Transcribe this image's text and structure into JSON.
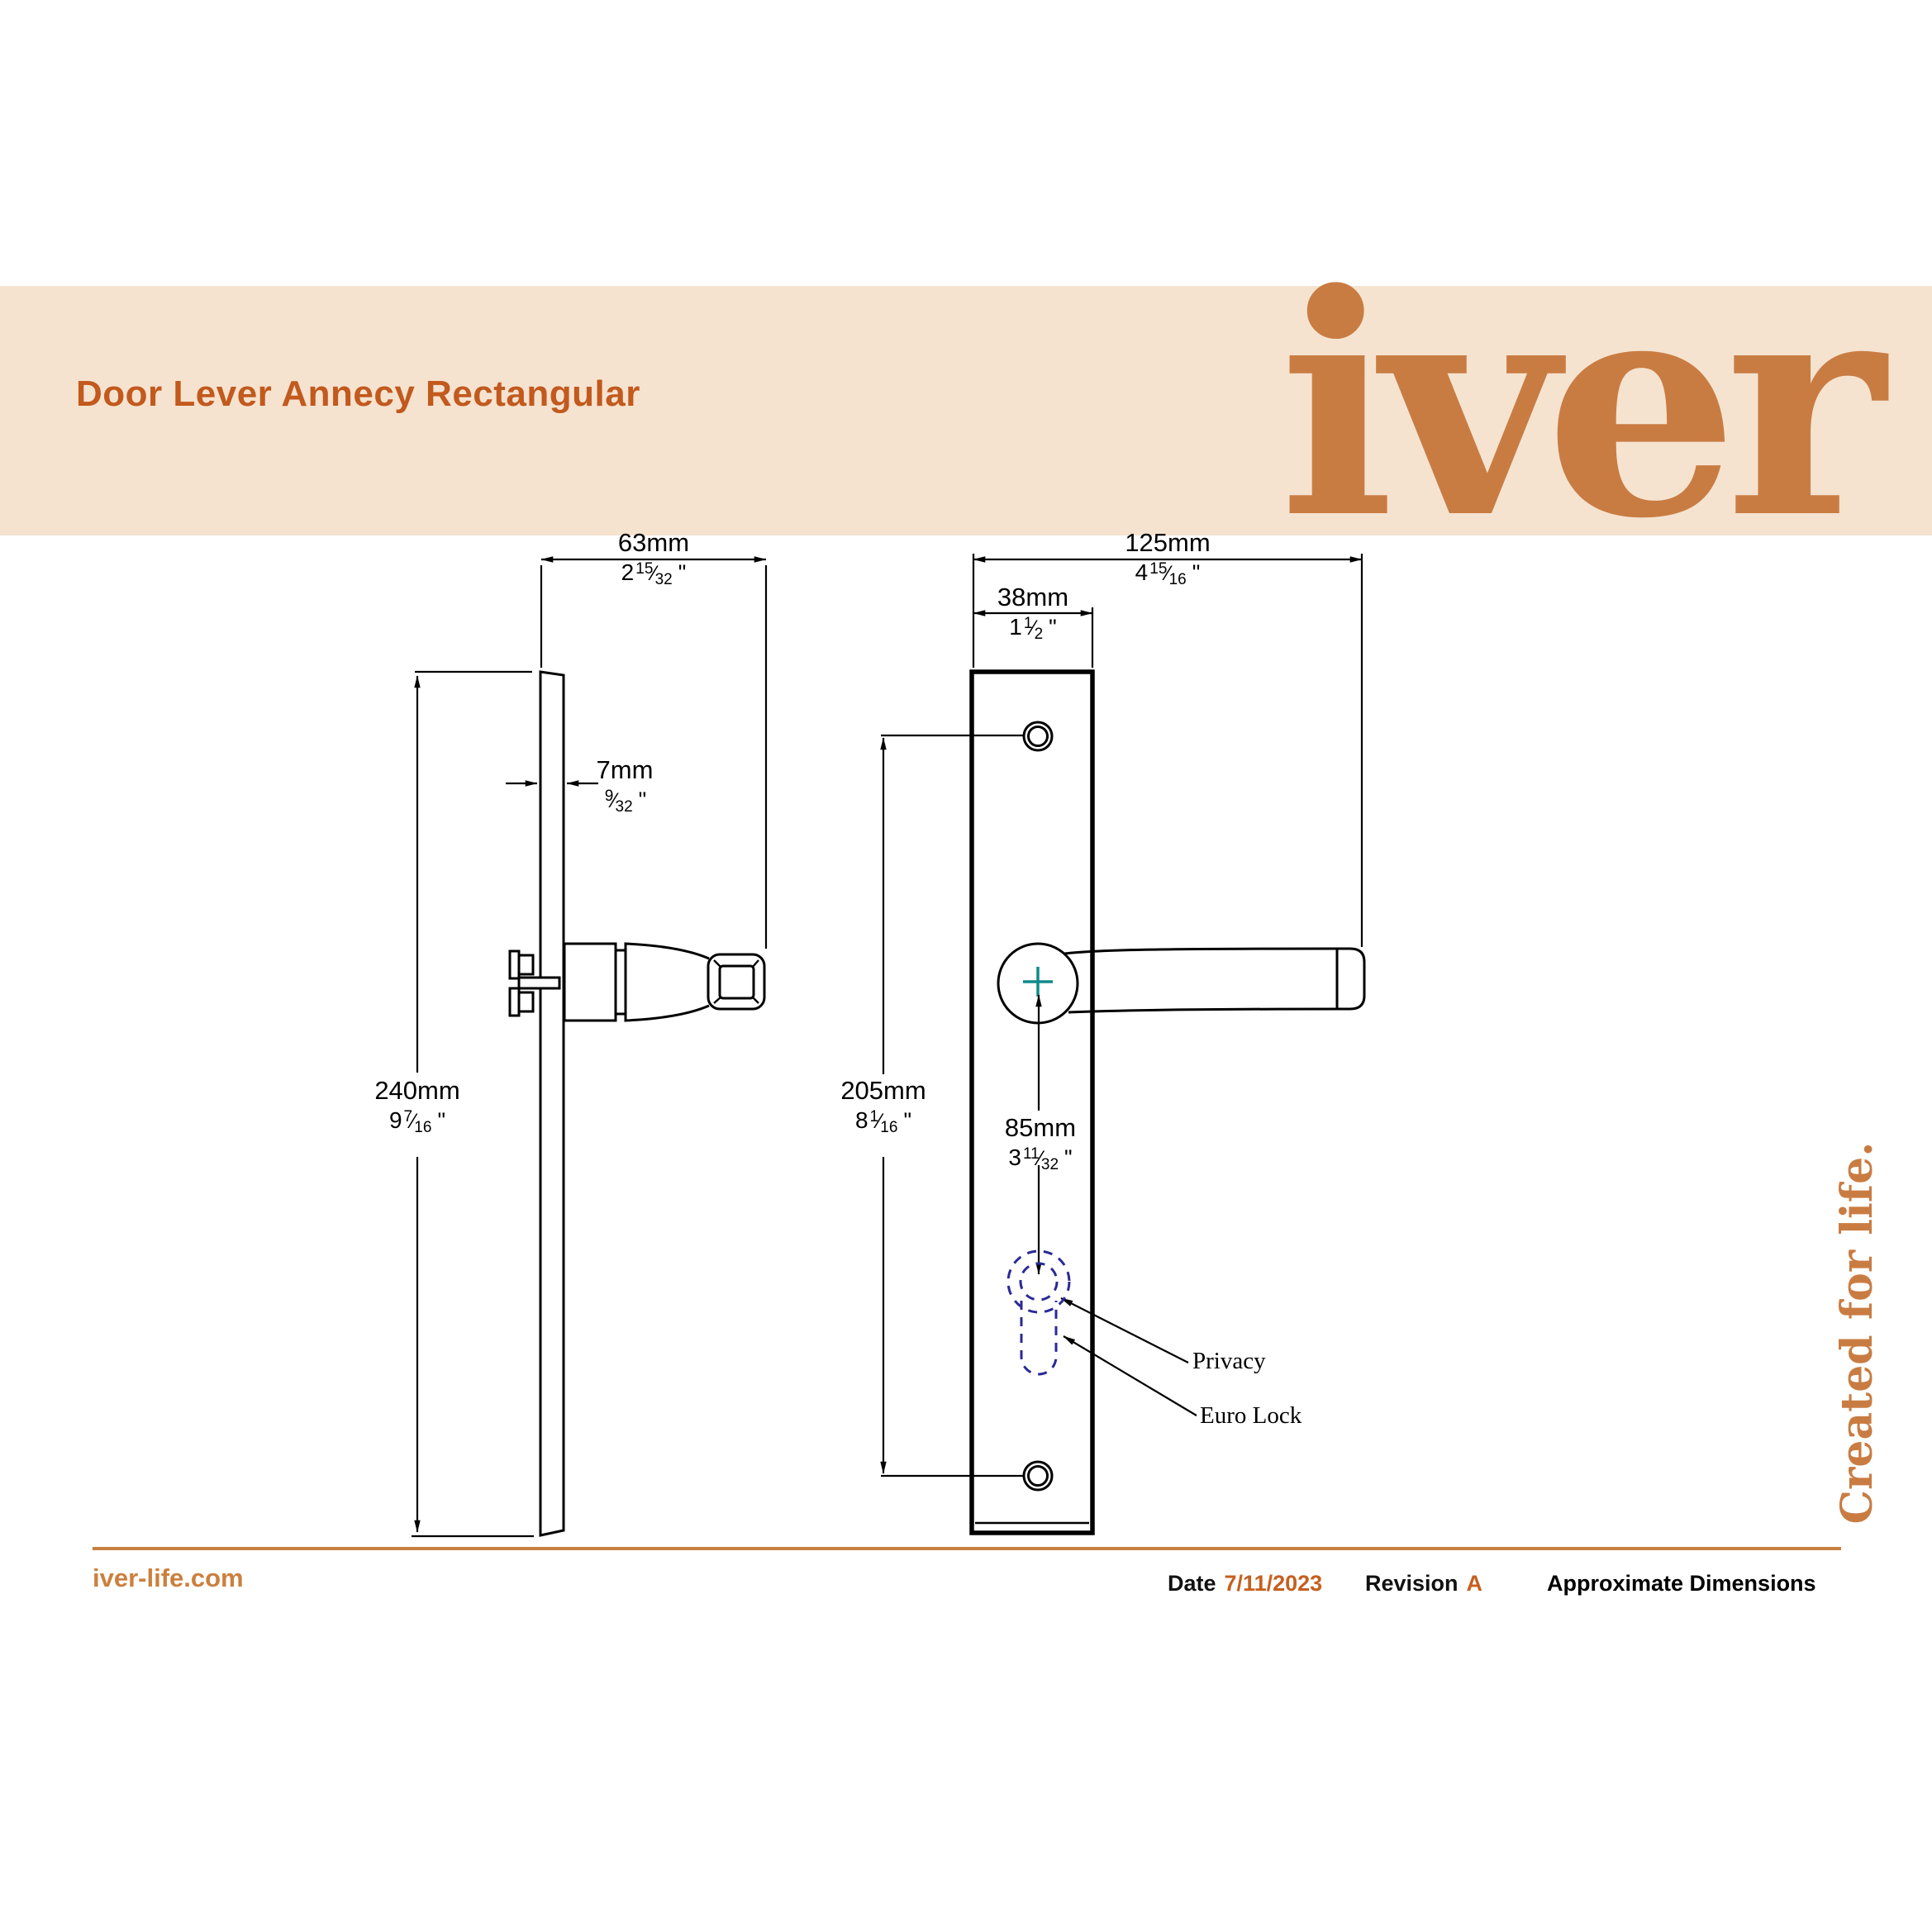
{
  "banner": {
    "title": "Door Lever Annecy Rectangular",
    "logo": "iver"
  },
  "tagline": "Created for life.",
  "symbols": {
    "slash": "⁄",
    "inch": "\""
  },
  "dims": {
    "side_width": {
      "mm": "63mm",
      "whole": "2",
      "num": "15",
      "den": "32"
    },
    "side_thickness": {
      "mm": "7mm",
      "whole": "",
      "num": "9",
      "den": "32"
    },
    "side_height": {
      "mm": "240mm",
      "whole": "9",
      "num": "7",
      "den": "16"
    },
    "front_width": {
      "mm": "125mm",
      "whole": "4",
      "num": "15",
      "den": "16"
    },
    "front_plate_width": {
      "mm": "38mm",
      "whole": "1",
      "num": "1",
      "den": "2"
    },
    "front_centres": {
      "mm": "205mm",
      "whole": "8",
      "num": "1",
      "den": "16"
    },
    "front_lock_centre": {
      "mm": "85mm",
      "whole": "3",
      "num": "11",
      "den": "32"
    }
  },
  "labels": {
    "privacy": "Privacy",
    "euro_lock": "Euro Lock"
  },
  "footer": {
    "website": "iver-life.com",
    "date_label": "Date",
    "date_value": "7/11/2023",
    "revision_label": "Revision",
    "revision_value": "A",
    "note": "Approximate Dimensions"
  },
  "colors": {
    "banner_bg": "#f5e3d0",
    "title_orange": "#c2591d",
    "logo_orange": "#c97c42",
    "line_black": "#000000",
    "lock_dashed_navy": "#2a2a96",
    "centre_cross_teal": "#0e8a8a",
    "footer_rule_orange": "#c6803e"
  }
}
